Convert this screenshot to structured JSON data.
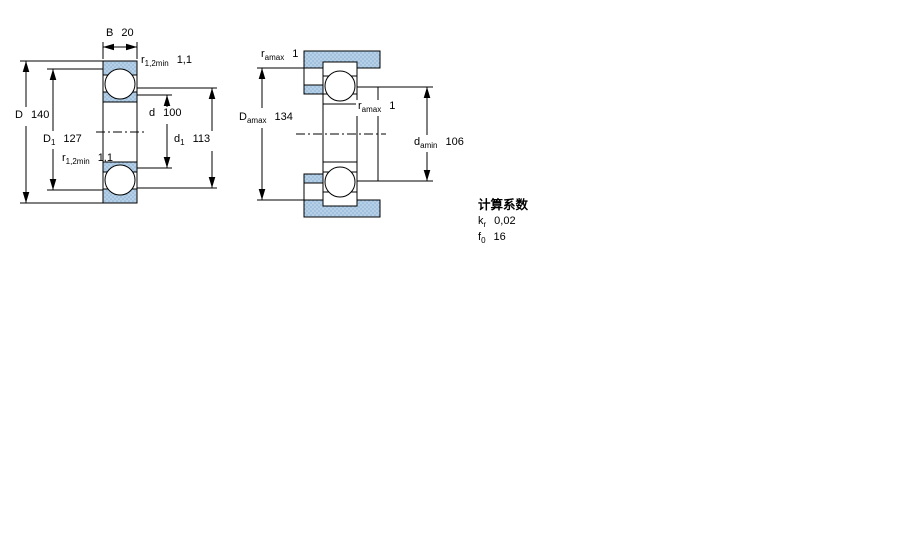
{
  "figure_left": {
    "dim_B": {
      "sym": "B",
      "val": "20"
    },
    "dim_D": {
      "sym": "D",
      "val": "140"
    },
    "dim_D1": {
      "sym": "D",
      "sub": "1",
      "val": "127"
    },
    "dim_d": {
      "sym": "d",
      "val": "100"
    },
    "dim_d1": {
      "sym": "d",
      "sub": "1",
      "val": "113"
    },
    "dim_r_top": {
      "sym": "r",
      "sub": "1,2min",
      "val": "1,1"
    },
    "dim_r_bottom": {
      "sym": "r",
      "sub": "1,2min",
      "val": "1,1"
    }
  },
  "figure_right": {
    "dim_ra_top": {
      "sym": "r",
      "sub": "amax",
      "val": "1"
    },
    "dim_ra_right": {
      "sym": "r",
      "sub": "amax",
      "val": "1"
    },
    "dim_Da": {
      "sym": "D",
      "sub": "amax",
      "val": "134"
    },
    "dim_da": {
      "sym": "d",
      "sub": "amin",
      "val": "106"
    }
  },
  "calculation_factors": {
    "heading": "计算系数",
    "rows": [
      {
        "sym": "k",
        "sub": "r",
        "val": "0,02"
      },
      {
        "sym": "f",
        "sub": "0",
        "val": "16"
      }
    ]
  },
  "colors": {
    "section_fill": "#b5d0e7",
    "section_dot": "#86aed2",
    "line": "#000000"
  }
}
